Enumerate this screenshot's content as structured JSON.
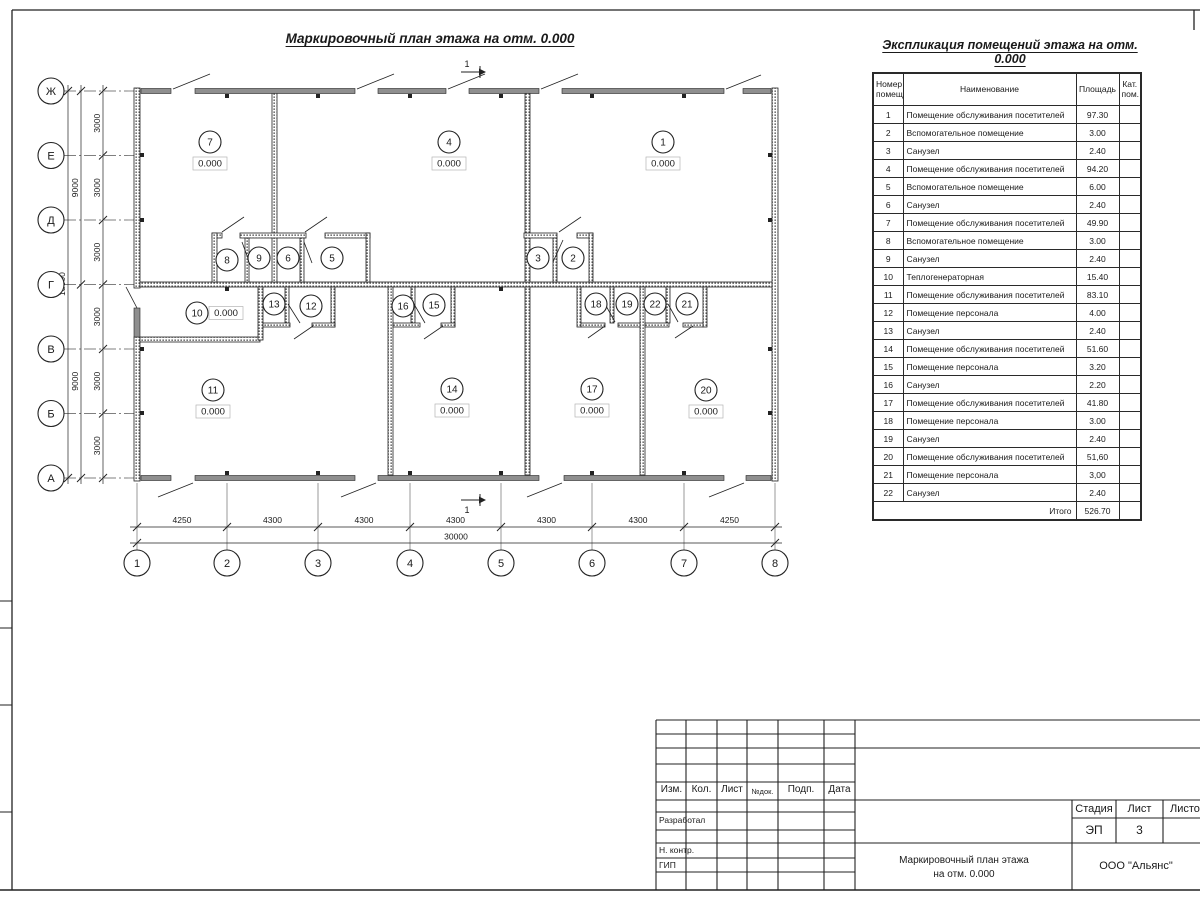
{
  "titles": {
    "plan": "Маркировочный план этажа на отм. 0.000",
    "schedule": "Экспликация помещений этажа на отм. 0.000"
  },
  "plan": {
    "axes_vertical": [
      "Ж",
      "Е",
      "Д",
      "Г",
      "В",
      "Б",
      "А"
    ],
    "axes_horizontal": [
      "1",
      "2",
      "3",
      "4",
      "5",
      "6",
      "7",
      "8"
    ],
    "dims_left_3000": [
      "3000",
      "3000",
      "3000",
      "3000",
      "3000",
      "3000"
    ],
    "dims_left_9000": [
      "9000",
      "9000"
    ],
    "dim_left_total": "18000",
    "dims_bottom": [
      "4250",
      "4300",
      "4300",
      "4300",
      "4300",
      "4300",
      "4250"
    ],
    "dim_bottom_total": "30000",
    "section_mark": "1",
    "rooms": [
      {
        "number": "1",
        "elevation": "0.000"
      },
      {
        "number": "2"
      },
      {
        "number": "3"
      },
      {
        "number": "4",
        "elevation": "0.000"
      },
      {
        "number": "5"
      },
      {
        "number": "6"
      },
      {
        "number": "7",
        "elevation": "0.000"
      },
      {
        "number": "8"
      },
      {
        "number": "9"
      },
      {
        "number": "10",
        "elevation": "0.000"
      },
      {
        "number": "11",
        "elevation": "0.000"
      },
      {
        "number": "12"
      },
      {
        "number": "13"
      },
      {
        "number": "14",
        "elevation": "0.000"
      },
      {
        "number": "15"
      },
      {
        "number": "16"
      },
      {
        "number": "17",
        "elevation": "0.000"
      },
      {
        "number": "18"
      },
      {
        "number": "19"
      },
      {
        "number": "20",
        "elevation": "0.000"
      },
      {
        "number": "21"
      },
      {
        "number": "22"
      }
    ]
  },
  "schedule": {
    "headers": {
      "number": "Номер помещ.",
      "name": "Наименование",
      "area": "Площадь",
      "category": "Кат. пом."
    },
    "rows": [
      {
        "number": "1",
        "name": "Помещение обслуживания посетителей",
        "area": "97.30"
      },
      {
        "number": "2",
        "name": "Вспомогательное помещение",
        "area": "3.00"
      },
      {
        "number": "3",
        "name": "Санузел",
        "area": "2.40"
      },
      {
        "number": "4",
        "name": "Помещение обслуживания посетителей",
        "area": "94.20"
      },
      {
        "number": "5",
        "name": "Вспомогательное помещение",
        "area": "6.00"
      },
      {
        "number": "6",
        "name": "Санузел",
        "area": "2.40"
      },
      {
        "number": "7",
        "name": "Помещение обслуживания посетителей",
        "area": "49.90"
      },
      {
        "number": "8",
        "name": "Вспомогательное помещение",
        "area": "3.00"
      },
      {
        "number": "9",
        "name": "Санузел",
        "area": "2.40"
      },
      {
        "number": "10",
        "name": "Теплогенераторная",
        "area": "15.40"
      },
      {
        "number": "11",
        "name": "Помещение обслуживания посетителей",
        "area": "83.10"
      },
      {
        "number": "12",
        "name": "Помещение персонала",
        "area": "4.00"
      },
      {
        "number": "13",
        "name": "Санузел",
        "area": "2.40"
      },
      {
        "number": "14",
        "name": "Помещение обслуживания посетителей",
        "area": "51.60"
      },
      {
        "number": "15",
        "name": "Помещение персонала",
        "area": "3.20"
      },
      {
        "number": "16",
        "name": "Санузел",
        "area": "2.20"
      },
      {
        "number": "17",
        "name": "Помещение обслуживания посетителей",
        "area": "41.80"
      },
      {
        "number": "18",
        "name": "Помещение персонала",
        "area": "3.00"
      },
      {
        "number": "19",
        "name": "Санузел",
        "area": "2.40"
      },
      {
        "number": "20",
        "name": "Помещение обслуживания посетителей",
        "area": "51,60"
      },
      {
        "number": "21",
        "name": "Помещение персонала",
        "area": "3,00"
      },
      {
        "number": "22",
        "name": "Санузел",
        "area": "2.40"
      }
    ],
    "total_label": "Итого",
    "total_area": "526.70"
  },
  "title_block": {
    "columns": [
      "Изм.",
      "Кол.",
      "Лист",
      "№док.",
      "Подп.",
      "Дата"
    ],
    "roles": [
      "Разработал",
      "Н. контр.",
      "ГИП"
    ],
    "stage_label": "Стадия",
    "sheet_label": "Лист",
    "sheets_label": "Листов",
    "stage": "ЭП",
    "sheet_number": "3",
    "doc_title_line1": "Маркировочный план этажа",
    "doc_title_line2": "на отм. 0.000",
    "company": "ООО \"Альянс\""
  },
  "colors": {
    "line": "#222222",
    "window_fill": "#8f8f8f"
  }
}
